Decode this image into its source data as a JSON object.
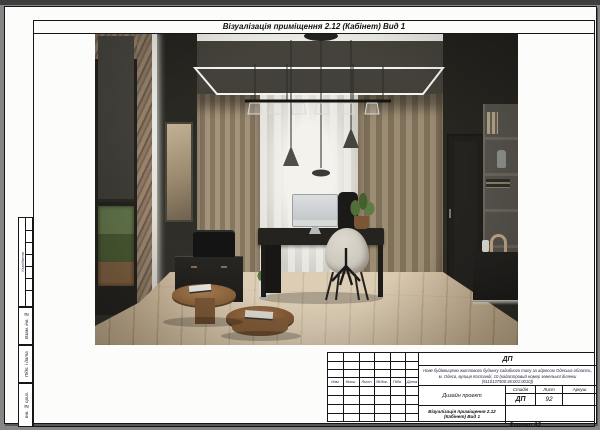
{
  "palette": {
    "bg_gray": "#868686",
    "sheet_white": "#fcfcfa",
    "line_black": "#161616",
    "ceiling_dark": "#38362f",
    "wall_dark": "#35332c",
    "wall_plaster": "#8d7965",
    "curtain_beige": "#a5947c",
    "curtain_sheer": "#e6e4de",
    "floor_wood": "#c7b191",
    "furniture_black": "#24231f",
    "chair_cream": "#ddd9cf",
    "glow_white": "#f0efea"
  },
  "sheet": {
    "page_title": "Візуалізація приміщення 2.12  (Кабінет) Вид 1",
    "format_label": "Формат А3"
  },
  "side_column": {
    "approvals_label": "Узгоджено",
    "labels": [
      "Взам. інв. №",
      "Підп. і дата",
      "Інв. № ориг."
    ]
  },
  "title_block": {
    "code": "ДП",
    "description_line1": "Нове будівництво житлового будинку садибного типу за адресою Одеська область,",
    "description_line2": "м. Одеса, вулиця Костанді, 10 (кадастровий номер земельної ділянки",
    "description_line3": "(5110137500:46:001:0010))",
    "revision_headers": [
      "Изм.",
      "Кільк.",
      "Лист",
      "№док.",
      "Підп.",
      "Дата"
    ],
    "project_type": "Дизайн проект",
    "stage_label": "Стадія",
    "sheet_label": "Лист",
    "sheets_label": "Аркуш",
    "stage_value": "ДП",
    "sheet_value": "92",
    "drawing_title": "Візуалізація приміщення 2.12 (Кабінет) Вид 1"
  }
}
